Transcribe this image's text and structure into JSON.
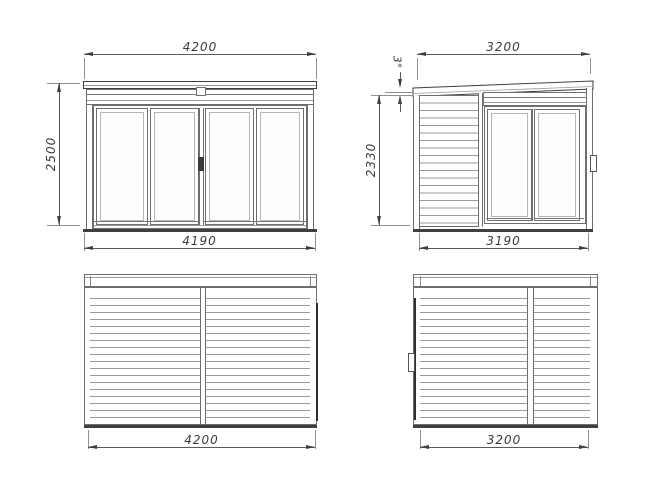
{
  "views": {
    "front": {
      "dim_top": "4200",
      "dim_left": "2500",
      "dim_bottom": "4190"
    },
    "side_right": {
      "dim_top": "3200",
      "dim_left": "2330",
      "dim_bottom": "3190",
      "roof_angle": "3°"
    },
    "back": {
      "dim_bottom": "4200"
    },
    "side_left": {
      "dim_bottom": "3200"
    }
  },
  "colors": {
    "line": "#3f3f3f",
    "slat": "#9a9a9a",
    "dim": "#5a5a5a",
    "text": "#3a3a3a",
    "dark": "#2e2e2e",
    "background": "#ffffff"
  }
}
